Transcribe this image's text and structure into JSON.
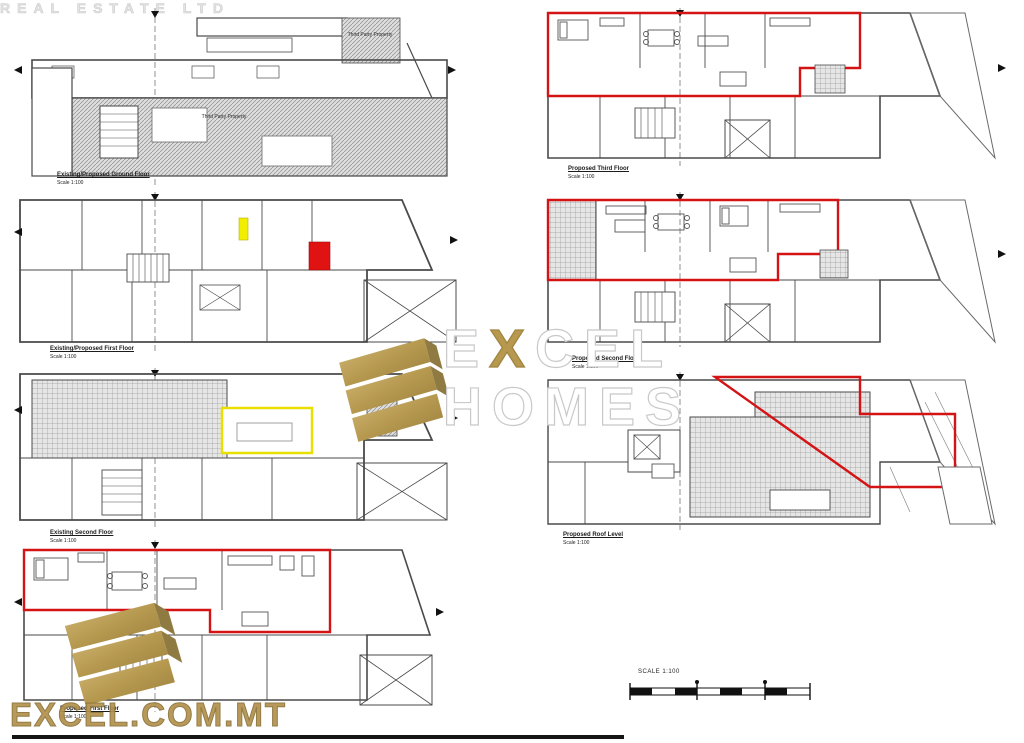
{
  "sheet": {
    "description": "Architectural planning drawing sheet with existing and proposed floor plans",
    "background": "#ffffff"
  },
  "colors": {
    "line": "#4a4a4a",
    "proposal_red": "#d41414",
    "demolition_yellow": "#f2ee00",
    "brand_gold": "#b6994f",
    "hatch_gray": "#8f8f8f"
  },
  "plans": [
    {
      "id": "ground",
      "title": "Existing/Proposed Ground Floor",
      "scale": "Scale 1:100"
    },
    {
      "id": "first",
      "title": "Existing/Proposed First Floor",
      "scale": "Scale 1:100"
    },
    {
      "id": "second-exist",
      "title": "Existing Second Floor",
      "scale": "Scale 1:100"
    },
    {
      "id": "first-prop",
      "title": "Proposed First Floor",
      "scale": "Scale 1:100"
    },
    {
      "id": "third-prop",
      "title": "Proposed Third Floor",
      "scale": "Scale 1:100"
    },
    {
      "id": "second-prop",
      "title": "Proposed Second Floor",
      "scale": "Scale 1:100"
    },
    {
      "id": "roof-prop",
      "title": "Proposed Roof Level",
      "scale": "Scale 1:100"
    }
  ],
  "annotations": {
    "third_party_1": "Third Party Property",
    "third_party_2": "Third Party Property"
  },
  "watermark": {
    "excel_e": "E",
    "excel_x": "X",
    "excel_cel": "CEL",
    "homes": "HOMES",
    "real_estate": "REAL ESTATE LTD"
  },
  "footer": {
    "url": "EXCEL.COM.MT"
  },
  "scale_bar": {
    "label": "SCALE 1:100"
  }
}
